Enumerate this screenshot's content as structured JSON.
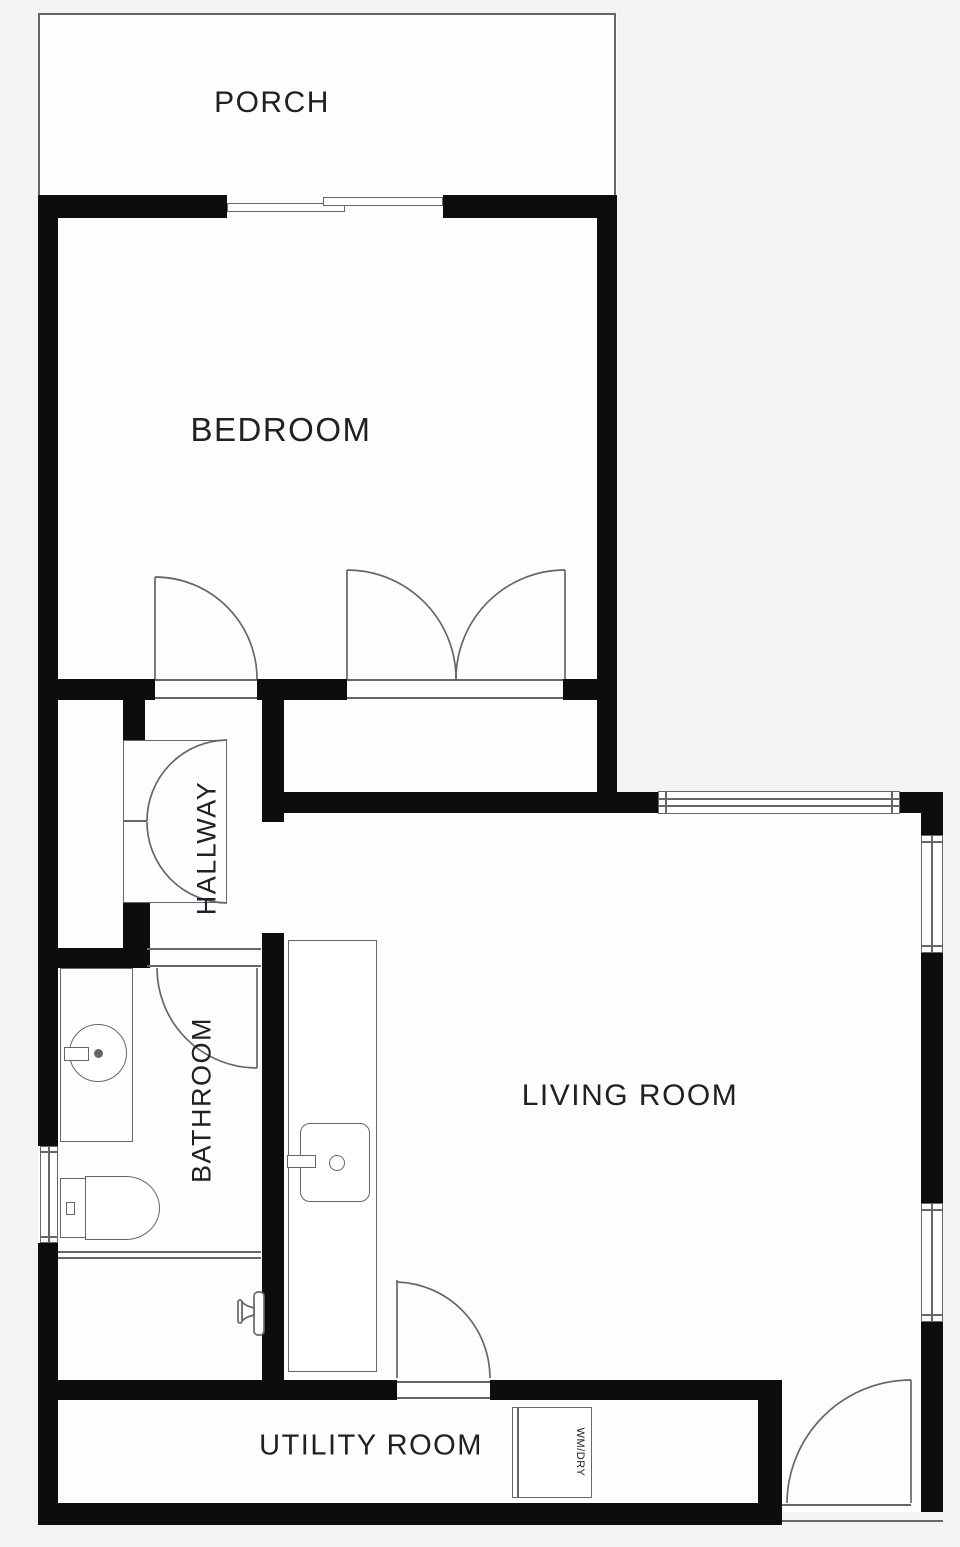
{
  "rooms": {
    "porch": {
      "label": "PORCH"
    },
    "bedroom": {
      "label": "BEDROOM"
    },
    "hallway": {
      "label": "HALLWAY"
    },
    "bathroom": {
      "label": "BATHROOM"
    },
    "living_room": {
      "label": "LIVING ROOM"
    },
    "utility_room": {
      "label": "UTILITY ROOM"
    }
  },
  "appliances": {
    "washer_dryer": {
      "label": "WM/DRY"
    }
  },
  "colors": {
    "wall": "#0d0d0d",
    "line": "#63676c",
    "floor": "#fcfdfe",
    "background": "#f2f3f5",
    "text": "#202124"
  }
}
